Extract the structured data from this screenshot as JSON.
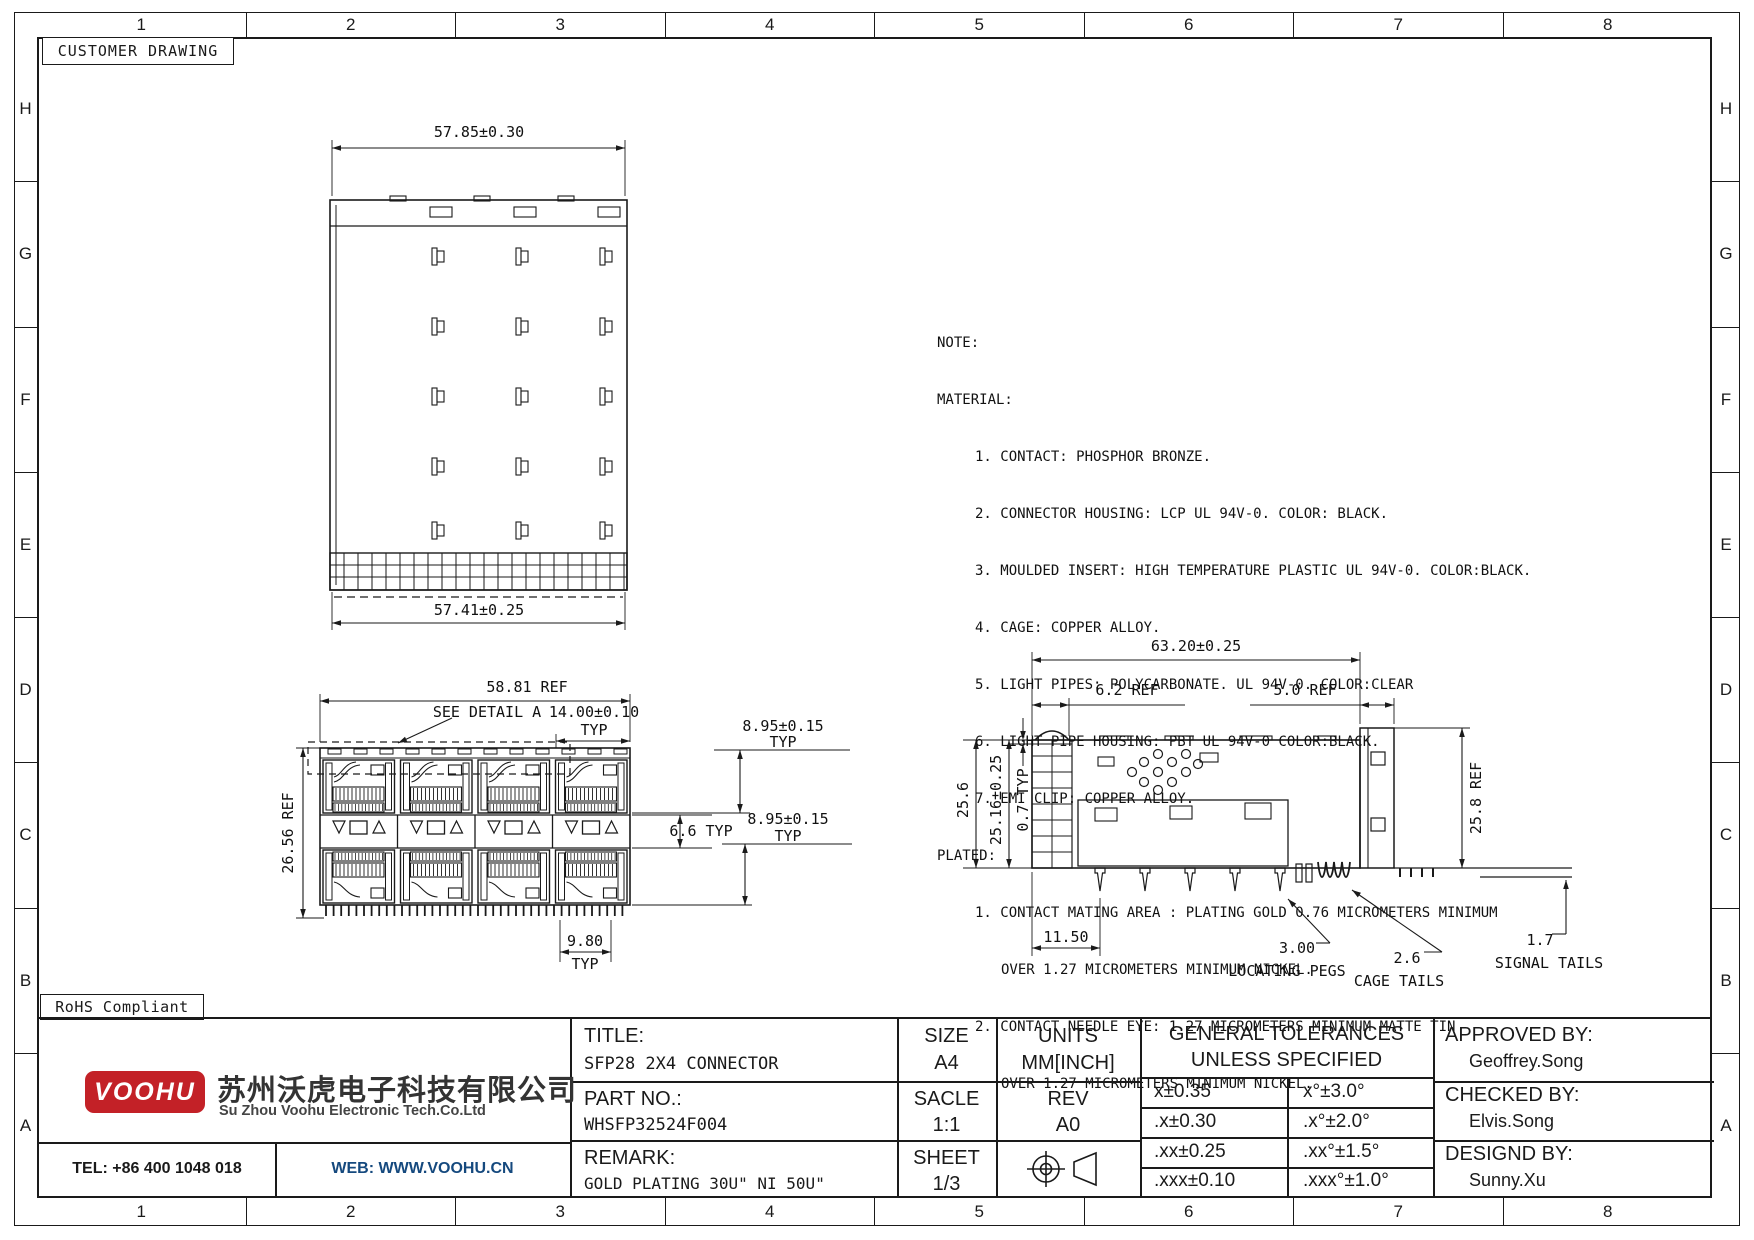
{
  "sheet": {
    "label": "CUSTOMER DRAWING",
    "rohs": "RoHS Compliant"
  },
  "frame": {
    "columns": [
      "1",
      "2",
      "3",
      "4",
      "5",
      "6",
      "7",
      "8"
    ],
    "rows": [
      "H",
      "G",
      "F",
      "E",
      "D",
      "C",
      "B",
      "A"
    ]
  },
  "views": {
    "top": {
      "dim_width_top": "57.85±0.30",
      "dim_width_bottom": "57.41±0.25"
    },
    "front": {
      "dim_width": "58.81 REF",
      "detail_callout": "SEE DETAIL A",
      "dim_pitch": "14.00±0.10",
      "typ": "TYP",
      "dim_port_height": "8.95±0.15",
      "dim_port_height2": "8.95±0.15",
      "dim_mid_height": "6.6 TYP",
      "dim_height": "26.56 REF",
      "dim_tail_pitch": "9.80"
    },
    "side": {
      "dim_length": "63.20±0.25",
      "dim_left_ref": "6.2 REF",
      "dim_right_ref": "5.0 REF",
      "dim_height_outer": "25.6",
      "dim_height_inner": "25.16±0.25",
      "dim_lip": "0.7 TYP",
      "dim_height_right": "25.8 REF",
      "dim_peg_offset": "11.50",
      "dim_peg": "3.00",
      "label_pegs": "LOCATING PEGS",
      "dim_cage_tail": "2.6",
      "label_cage_tails": "CAGE TAILS",
      "dim_signal_tail": "1.7",
      "label_signal_tails": "SIGNAL TAILS"
    }
  },
  "notes": {
    "title": "NOTE:",
    "lines": [
      {
        "t": "MATERIAL:",
        "i": 0
      },
      {
        "t": "1. CONTACT: PHOSPHOR BRONZE.",
        "i": 1
      },
      {
        "t": "2. CONNECTOR HOUSING: LCP UL 94V-0. COLOR: BLACK.",
        "i": 1
      },
      {
        "t": "3. MOULDED INSERT: HIGH TEMPERATURE PLASTIC UL 94V-0. COLOR:BLACK.",
        "i": 1
      },
      {
        "t": "4. CAGE: COPPER ALLOY.",
        "i": 1
      },
      {
        "t": "5. LIGHT PIPES: POLYCARBONATE. UL 94V-0. COLOR:CLEAR",
        "i": 1
      },
      {
        "t": "6. LIGHT PIPE HOUSING: PBT UL 94V-0 COLOR:BLACK.",
        "i": 1
      },
      {
        "t": "7. EMI CLIP: COPPER ALLOY.",
        "i": 1
      },
      {
        "t": "PLATED:",
        "i": 0
      },
      {
        "t": "1. CONTACT MATING AREA : PLATING GOLD 0.76 MICROMETERS MINIMUM",
        "i": 1
      },
      {
        "t": "OVER 1.27 MICROMETERS MINIMUM NICKEL.",
        "i": 2
      },
      {
        "t": "2. CONTACT NEEDLE EYE: 1.27 MICROMETERS MINIMUM MATTE TIN",
        "i": 1
      },
      {
        "t": "OVER 1.27 MICROMETERS MINIMUM NICKEL.",
        "i": 2
      }
    ]
  },
  "title_block": {
    "title_label": "TITLE:",
    "title": "SFP28 2X4 CONNECTOR",
    "size_label": "SIZE",
    "size": "A4",
    "units_label": "UNITS",
    "units": "MM[INCH]",
    "partno_label": "PART NO.:",
    "partno": "WHSFP32524F004",
    "scale_label": "SACLE",
    "scale": "1:1",
    "rev_label": "REV",
    "rev": "A0",
    "remark_label": "REMARK:",
    "remark": "GOLD PLATING 30U\"  NI 50U\"",
    "sheet_label": "SHEET",
    "sheet": "1/3",
    "tol_header1": "GENERAL TOLERANCES",
    "tol_header2": "UNLESS SPECIFIED",
    "tolerances": [
      [
        "x±0.35",
        "x°±3.0°"
      ],
      [
        ".x±0.30",
        ".x°±2.0°"
      ],
      [
        ".xx±0.25",
        ".xx°±1.5°"
      ],
      [
        ".xxx±0.10",
        ".xxx°±1.0°"
      ]
    ],
    "approved_label": "APPROVED BY:",
    "approved": "Geoffrey.Song",
    "checked_label": "CHECKED BY:",
    "checked": "Elvis.Song",
    "designed_label": "DESIGND BY:",
    "designed": "Sunny.Xu"
  },
  "company": {
    "logo_text": "VOOHU",
    "name_cn": "苏州沃虎电子科技有限公司",
    "name_en": "Su Zhou Voohu Electronic Tech.Co.Ltd",
    "tel": "TEL: +86 400 1048 018",
    "web": "WEB: WWW.VOOHU.CN"
  },
  "colors": {
    "line": "#1a1a1a",
    "logo_red": "#c32127",
    "web_blue": "#15497e"
  }
}
